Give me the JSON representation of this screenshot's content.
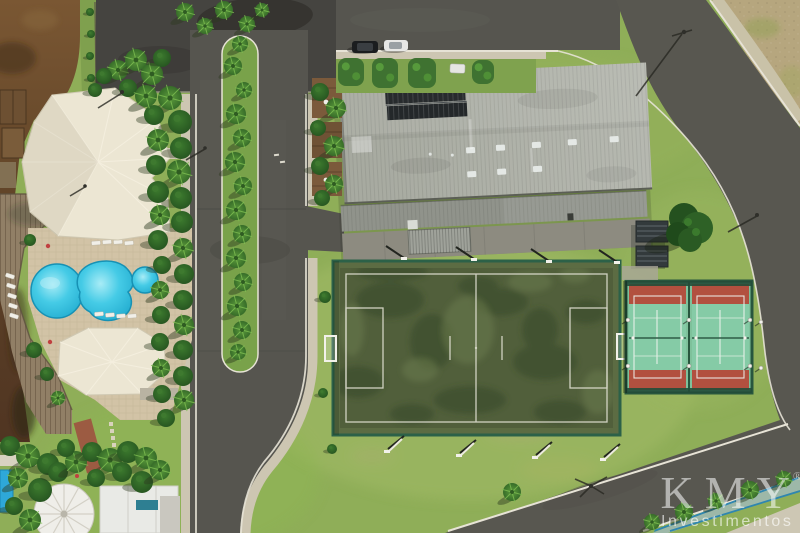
{
  "image_type": "aerial-drone-photograph",
  "watermark": {
    "brand": "KMY",
    "registered": "®",
    "subtitle": "Investimentos"
  },
  "palette": {
    "grass": "#8fae58",
    "pool_water": "#2bb9dc",
    "canal_water": "#6b4a2c",
    "turf_green": "#515f3b",
    "fence_green": "#2c6148",
    "court_green": "#85cba6",
    "court_red": "#b2503f",
    "asphalt": "#56554f",
    "asphalt_dark": "#454440",
    "sidewalk": "#cdc6b2",
    "curb": "#e7e3d6",
    "roof_cream": "#ece6d3",
    "warehouse_roof": "#a6a99f",
    "dry_field": "#b6a67e",
    "bike_path_blue": "#2f86b0",
    "watermark_white": "#ffffff"
  }
}
